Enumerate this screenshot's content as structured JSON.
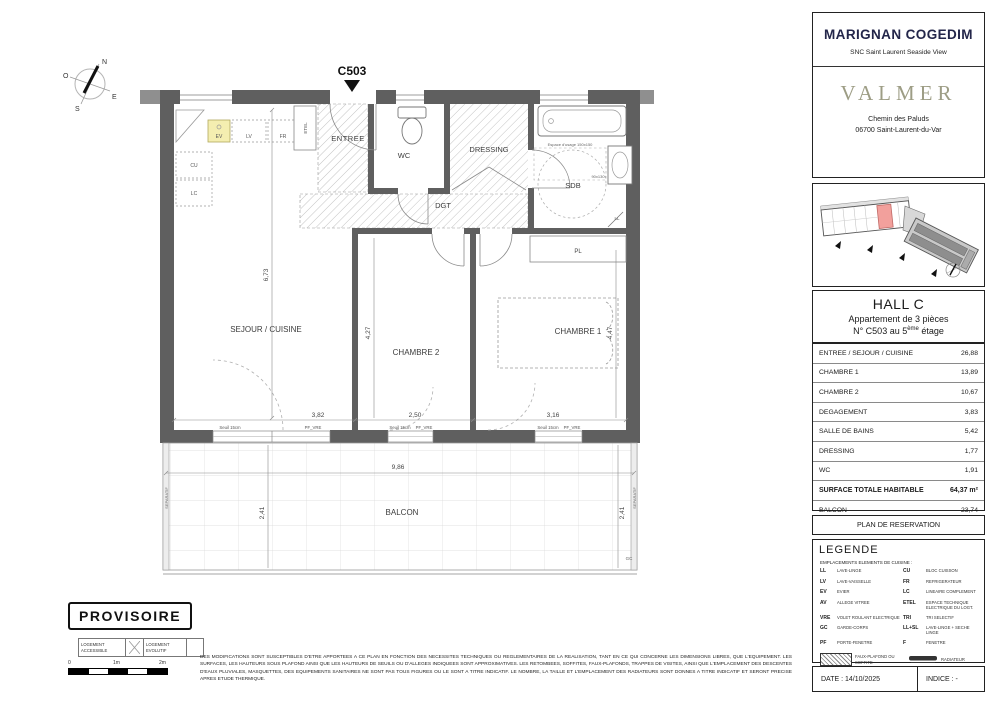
{
  "sidebar": {
    "brand": {
      "line1_a": "MARIGNAN",
      "line1_b": "COGEDIM",
      "subtitle": "SNC Saint Laurent Seaside View",
      "project": "VALMER",
      "address_line1": "Chemin des Paluds",
      "address_line2": "06700 Saint-Laurent-du-Var"
    },
    "unit": {
      "hall": "HALL C",
      "type": "Appartement de 3 pièces",
      "number_prefix": "N° C503 au 5",
      "floor_sup": "ème",
      "number_suffix": " étage"
    },
    "areas": {
      "rows": [
        {
          "label": "ENTREE / SEJOUR / CUISINE",
          "value": "26,88"
        },
        {
          "label": "CHAMBRE 1",
          "value": "13,89"
        },
        {
          "label": "CHAMBRE 2",
          "value": "10,67"
        },
        {
          "label": "DEGAGEMENT",
          "value": "3,83"
        },
        {
          "label": "SALLE DE BAINS",
          "value": "5,42"
        },
        {
          "label": "DRESSING",
          "value": "1,77"
        },
        {
          "label": "WC",
          "value": "1,91"
        }
      ],
      "total_label": "SURFACE TOTALE HABITABLE",
      "total_value": "64,37 m²",
      "balcon_label": "BALCON",
      "balcon_value": "23,74"
    },
    "reservation": "PLAN DE RESERVATION",
    "legend": {
      "title": "LEGENDE",
      "subtitle": "EMPLACEMENTS ELEMENTS DE CUISINE :",
      "rows": [
        {
          "a": "LL",
          "ad": "LAVE-LINGE",
          "b": "CU",
          "bd": "BLOC CUISSON"
        },
        {
          "a": "LV",
          "ad": "LAVE-VAISSELLE",
          "b": "FR",
          "bd": "REFRIGERATEUR"
        },
        {
          "a": "EV",
          "ad": "EVIER",
          "b": "LC",
          "bd": "LINEAIRE COMPLEMENT"
        },
        {
          "a": "AV",
          "ad": "ALLEGE VITREE",
          "b": "ETEL",
          "bd": "ESPACE TECHNIQUE ELECTRIQUE DU LOGT."
        },
        {
          "a": "VRE",
          "ad": "VOLET ROULANT ELECTRIQUE",
          "b": "TRI",
          "bd": "TRI SELECTIF"
        },
        {
          "a": "GC",
          "ad": "GARDE-CORPS",
          "b": "LL+SL",
          "bd": "LAVE-LINGE + SECHE LINGE"
        },
        {
          "a": "PF",
          "ad": "PORTE-FENETRE",
          "b": "F",
          "bd": "FENETRE"
        }
      ],
      "faux_plafond": "FAUX-PLAFOND OU SOFFITE",
      "radiateur": "RADIATEUR",
      "retombee": "RETOMBEE DE POUTRE",
      "seche": "SECHE-SERV."
    },
    "footer": {
      "date": "DATE : 14/10/2025",
      "indice": "INDICE : -"
    }
  },
  "plan": {
    "unit_label": "C503",
    "compass": {
      "n": "N",
      "s": "S",
      "e": "E",
      "o": "O"
    },
    "rooms": {
      "entree": "ENTREE",
      "wc": "WC",
      "dressing": "DRESSING",
      "sdb": "SDB",
      "dgt": "DGT",
      "sejour": "SEJOUR / CUISINE",
      "chambre2": "CHAMBRE 2",
      "chambre1": "CHAMBRE 1",
      "balcon": "BALCON",
      "pl": "PL",
      "ll": "LL",
      "etel": "ETEL"
    },
    "kitchen": {
      "ev": "EV",
      "lv": "LV",
      "fr": "FR",
      "cu": "CU",
      "lc": "LC"
    },
    "dims": {
      "sejour_h": "6,73",
      "sejour_w": "3,82",
      "ch2_h": "4,27",
      "ch2_w": "2,50",
      "ch1_h": "4,47",
      "ch1_w": "3,16",
      "balcon_w": "9,86",
      "balcon_d": "2,41",
      "balcon_d2": "2,41"
    },
    "annotations": {
      "seuil": "Seuil 15cm",
      "pf_vre": "PF_VRE",
      "separatif": "SEPARATIF",
      "gc": "GC",
      "usage": "Espace d'usage 150x150",
      "u90": "90x130"
    }
  },
  "stamp": {
    "provisoire": "PROVISOIRE",
    "accessible": "LOGEMENT ACCESSIBLE",
    "evolutif": "LOGEMENT EVOLUTIF"
  },
  "scalebar": {
    "t0": "0",
    "t1": "1m",
    "t2": "2m"
  },
  "disclaimer": "DES MODIFICATIONS SONT SUSCEPTIBLES D'ETRE APPORTEES A CE PLAN EN FONCTION DES NECESSITES TECHNIQUES OU REGLEMENTAIRES DE LA REALISATION, TANT EN CE QUI CONCERNE LES DIMENSIONS LIBRES, QUE L'EQUIPEMENT. LES SURFACES, LES HAUTEURS SOUS PLAFOND AINSI QUE LES HAUTEURS DE SEUILS OU D'ALLEGES INDIQUEES SONT APPROXIMATIVES. LES RETOMBEES, SOFFITES, FAUX-PLAFONDS, TRAPPES DE VISITES, AINSI QUE L'EMPLACEMENT DES DESCENTES D'EAUX PLUVIALES, MASQUETTES, DES EQUIPEMENTS SANITAIRES NE SONT PAS TOUS FIGURES OU LE SONT A TITRE INDICATIF. LE NOMBRE, LA TAILLE ET L'EMPLACEMENT DES RADIATEURS SONT DONNES A TITRE INDICATIF ET SERONT PRECISE APRES ETUDE THERMIQUE."
}
